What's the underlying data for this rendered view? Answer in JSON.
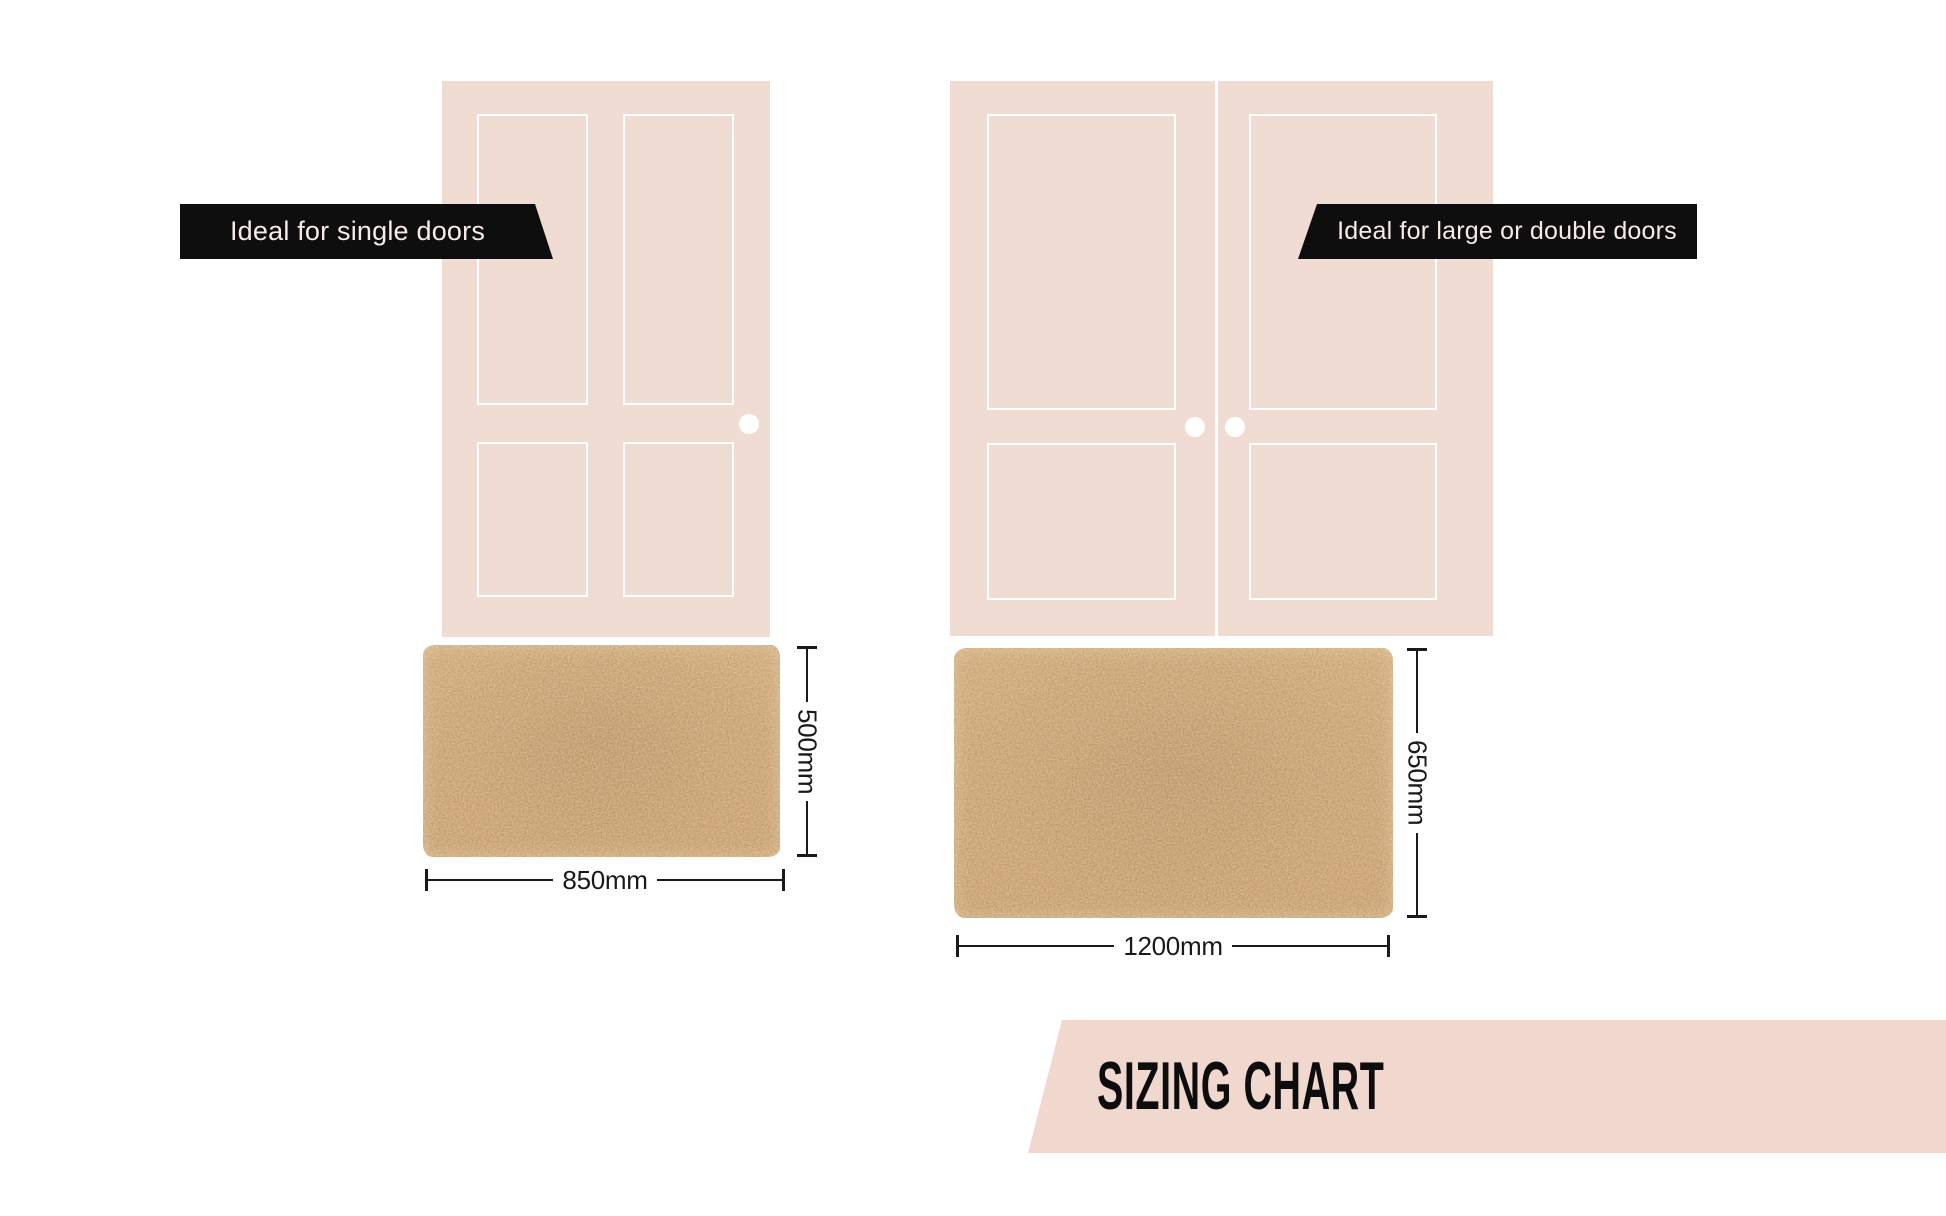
{
  "page": {
    "background": "#ffffff",
    "width": 1946,
    "height": 1216
  },
  "left_group": {
    "banner_label": "Ideal for single doors",
    "door_type": "single door",
    "mat": {
      "width_label": "850mm",
      "height_label": "500mm",
      "width_mm": 850,
      "height_mm": 500
    }
  },
  "right_group": {
    "banner_label": "Ideal for large or double doors",
    "door_type": "double door",
    "mat": {
      "width_label": "1200mm",
      "height_label": "650mm",
      "width_mm": 1200,
      "height_mm": 650
    }
  },
  "footer": {
    "title": "SIZING CHART"
  },
  "colors": {
    "door_pink": "#f1dcd3",
    "ribbon_black": "#0e0e0e",
    "ribbon_text": "#f6ebe6",
    "mat_tan": "#c6975f",
    "footer_pink": "#f1d8cf",
    "dimension_ink": "#1a1a1a"
  }
}
